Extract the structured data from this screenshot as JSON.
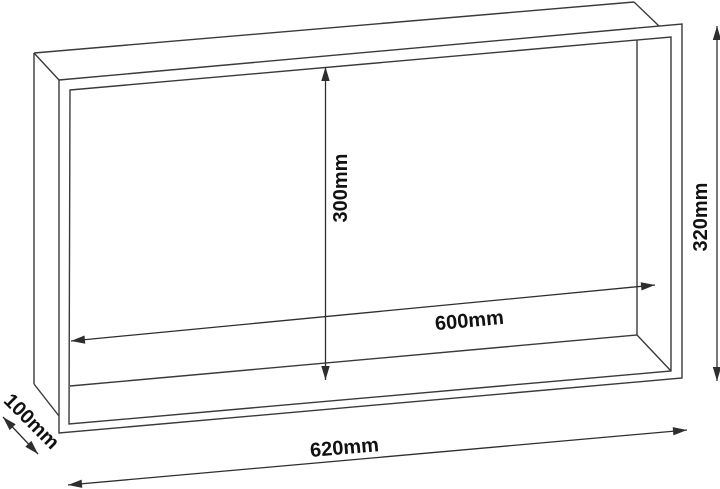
{
  "figure": {
    "kind": "technical-line-drawing",
    "subject_label": "open-front rectangular niche box"
  },
  "dimensions": {
    "outer_width": "620mm",
    "outer_height": "320mm",
    "inner_width": "600mm",
    "inner_height": "300mm",
    "depth": "100mm"
  },
  "colors": {
    "background": "#ffffff",
    "box_line": "#3a3a3a",
    "dimension_line": "#2e2e2e",
    "label_text": "#111111"
  }
}
